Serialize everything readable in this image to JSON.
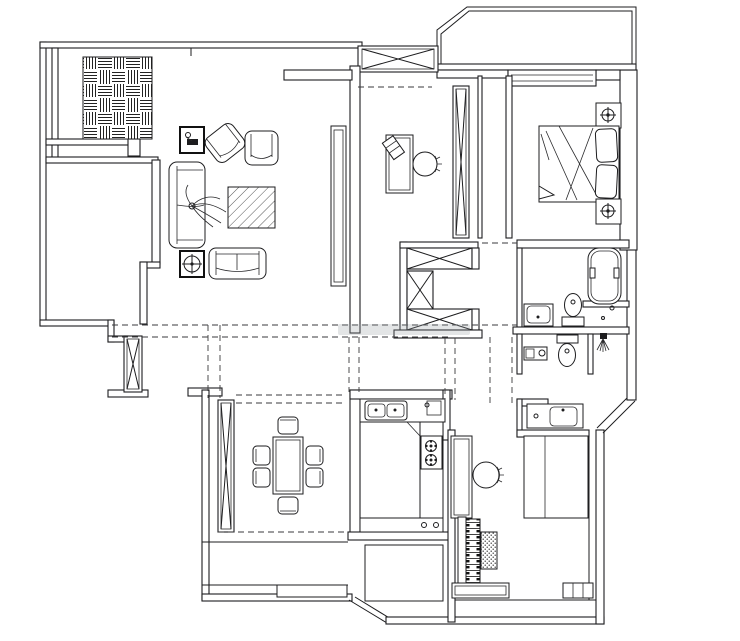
{
  "meta": {
    "kind": "apartment-floor-plan-drawing",
    "width_px": 740,
    "height_px": 641
  },
  "colors": {
    "background": "#ffffff",
    "line": "#1d1d1f",
    "dashed_guides": "#3a3a3c",
    "watermark_smudge": "#9aa0a6"
  },
  "rooms": [
    {
      "id": "living-room",
      "symbols": [
        "parquet-closet",
        "side-table-lamp-icon",
        "armchair",
        "armchair",
        "sofa",
        "plant",
        "rug-diagonal-hatch",
        "side-table-crosshair-icon",
        "loveseat",
        "tv-cabinet"
      ]
    },
    {
      "id": "study",
      "symbols": [
        "desk",
        "book",
        "chair",
        "window-x-column"
      ]
    },
    {
      "id": "master-bedroom",
      "symbols": [
        "double-bed",
        "pillows",
        "nightstand-lamp-icon",
        "nightstand-lamp-icon",
        "window-band"
      ]
    },
    {
      "id": "bathroom",
      "symbols": [
        "bathtub",
        "toilet",
        "wash-basin",
        "toilet",
        "shower-head-icon",
        "wash-basin",
        "shelf"
      ]
    },
    {
      "id": "hallway",
      "symbols": [
        "elevator-shaft-x-boxes",
        "ceiling-dashed-guides"
      ]
    },
    {
      "id": "dining-room",
      "symbols": [
        "dining-table",
        "chair",
        "chair",
        "chair",
        "chair",
        "chair",
        "chair",
        "window-x-column"
      ]
    },
    {
      "id": "kitchen",
      "symbols": [
        "double-sink",
        "gas-stove-2-burner",
        "u-shaped-counter"
      ]
    },
    {
      "id": "piano-room",
      "symbols": [
        "desk",
        "chair",
        "piano-keys",
        "dotted-stool",
        "wardrobe",
        "shelf",
        "radiator"
      ]
    },
    {
      "id": "balcony",
      "symbols": [
        "angled-parapet"
      ]
    }
  ],
  "watermark": {
    "legible": false,
    "note": "faint gray smudge band near plan center"
  }
}
